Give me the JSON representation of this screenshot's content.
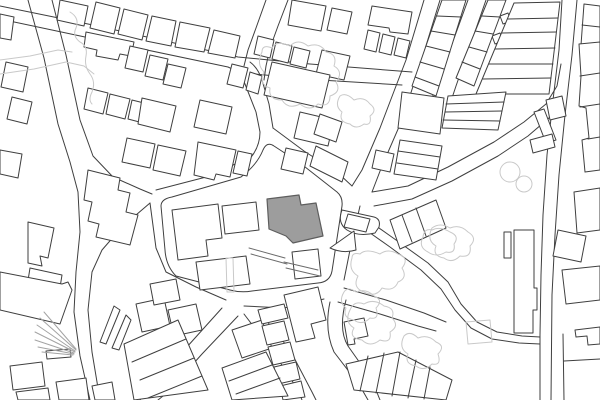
{
  "map": {
    "kind": "architectural-site-plan-figure-ground",
    "background": "#ffffff",
    "colors": {
      "outline": "#3f3f3f",
      "light": "#c9c9c9",
      "rail": "#a3a3a3",
      "site_fill": "#9d9d9d",
      "site_stroke": "#5e5e5e",
      "steps": "#6b6b6b",
      "white": "#ffffff"
    },
    "layers": [
      {
        "name": "road-edges",
        "stroke": "outline",
        "fill": "none",
        "width": 1,
        "paths": [
          "M0,6 L88,24 L238,57 L310,64 L412,72",
          "M0,19 L85,37 L228,67",
          "M254,74 L320,80 L402,85",
          "M266,0 L256,28 L248,50 L244,66",
          "M288,0 L278,26 L270,48 L266,66 L264,80",
          "M228,67 Q240,72 245,84 L256,112 L260,132 Q260,145 252,156 L210,176 L156,190",
          "M250,62 Q258,68 262,80 L269,104 L273,128",
          "M273,128 L304,151 L338,173 L352,186",
          "M28,0 L44,58 L58,124 L70,162 L78,192 L80,232 L76,272 L74,312 L80,356 L90,400",
          "M52,0 L66,55 L80,120 L93,156 L113,177 L140,189 L152,194",
          "M150,203 L122,227 L102,250 L92,272 L88,310 L92,352 L100,400",
          "M150,203 L156,248 L166,272 L196,287 L226,300",
          "M222,308 L186,348 L152,386 L140,400",
          "M238,316 L202,354 L168,392 L158,400",
          "M244,314 L276,356 L298,390 L302,400",
          "M258,310 L290,350 L312,392 L316,400",
          "M244,306 L284,308 L324,299",
          "M360,206 L350,250 L344,280",
          "M330,302 Q324,330 334,352 L360,386 L368,400",
          "M346,300 Q338,330 348,346 L372,380 L380,400",
          "M344,288 L386,300 L424,313 L446,322",
          "M338,302 L380,314 L418,326 L436,331",
          "M424,0 L406,60 L396,86 L380,128 L362,170 L352,186",
          "M440,0 L421,62 L402,120 L382,166 L372,192",
          "M372,192 L408,186 L448,167 L494,142 L524,122 L546,104 L557,86 L561,64",
          "M374,206 L412,199 L452,181 L498,156 L528,136 L549,118 L556,102",
          "M468,0 L452,44 L438,82 L432,98",
          "M486,0 L470,46 L456,86 L448,110 L444,126",
          "M562,0 L559,50 L553,100 L547,155 L543,215 L541,275 L540,335 L540,400",
          "M577,0 L572,55 L565,115 L559,175 L555,235 L552,295 L551,400",
          "M362,216 L396,240 L428,263 L448,282 L461,304 L477,322 L497,332 L522,336 L540,337",
          "M356,223 L390,247 L421,270 L441,289 L455,310 L471,328 L492,339 L519,343 L540,344",
          "M563,334 L564,400",
          "M564,361 L600,359"
        ]
      },
      {
        "name": "blocks",
        "stroke": "outline",
        "fill": "white",
        "width": 1,
        "paths": [
          "M161,206 L165,250 Q166,266 176,276 L230,290 Q241,293 252,291 L318,283 Q330,282 332,271 L342,206 Q343,197 337,192 L300,163 L274,146 Q267,141 263,150 Q257,165 241,177 L172,197 Q161,199 161,206 Z",
          "M342,210 L374,217 Q381,219 379,227 L375,233 Q358,237 347,230 Q337,223 342,210 Z"
        ]
      },
      {
        "name": "buildings",
        "stroke": "outline",
        "fill": "white",
        "width": 1,
        "paths": [
          "M96,2 L120,8 L114,34 L90,28 Z",
          "M124,9 L148,15 L142,40 L118,34 Z",
          "M152,16 L176,21 L171,46 L146,41 Z",
          "M180,22 L210,28 L204,52 L175,47 Z",
          "M214,30 L240,36 L235,58 L208,53 Z",
          "M60,0 L88,6 L84,26 L57,20 Z",
          "M292,0 L326,6 L321,31 L288,25 Z",
          "M332,8 L352,12 L347,34 L327,30 Z",
          "M372,6 L412,12 L408,34 L390,32 L389,28 L368,25 Z",
          "M368,30 L380,33 L376,52 L364,49 Z",
          "M383,34 L395,37 L391,55 L379,52 Z",
          "M398,38 L410,41 L406,58 L394,55 Z",
          "M0,14 L14,17 L11,40 L0,38 Z",
          "M6,62 L28,67 L23,92 L1,87 Z",
          "M12,97 L32,102 L27,124 L7,119 Z",
          "M0,150 L22,154 L18,178 L0,174 Z",
          "M28,222 L54,228 L48,258 L40,256 L42,266 L28,263 Z",
          "M30,268 L62,275 L58,300 L26,293 Z",
          "M86,32 L134,42 L131,56 L120,54 L118,60 L96,56 L97,50 L84,47 Z",
          "M130,46 L148,50 L143,72 L125,68 Z",
          "M150,55 L168,59 L163,80 L145,76 Z",
          "M168,64 L186,68 L181,88 L163,84 Z",
          "M88,88 L108,93 L103,114 L84,109 Z",
          "M110,94 L130,99 L125,119 L106,114 Z",
          "M132,100 L152,105 L147,124 L128,119 Z",
          "M142,98 L176,106 L170,132 L138,124 Z",
          "M127,138 L155,144 L150,168 L122,162 Z",
          "M158,145 L186,151 L180,176 L153,170 Z",
          "M198,142 L236,150 L230,177 L216,174 L214,180 L194,175 Z",
          "M238,151 L252,154 L247,176 L233,173 Z",
          "M200,100 L232,107 L226,134 L194,127 Z",
          "M232,64 L248,68 L243,88 L227,84 Z",
          "M250,72 L262,76 L258,94 L246,90 Z",
          "M258,36 L274,40 L270,58 L254,54 Z",
          "M276,42 L292,46 L288,63 L272,59 Z",
          "M294,47 L310,51 L306,68 L290,64 Z",
          "M322,50 L350,56 L344,80 L316,74 Z",
          "M272,62 L330,75 L322,108 L264,95 Z",
          "M300,112 L334,120 L328,146 L294,138 Z",
          "M286,148 L308,153 L303,174 L281,169 Z",
          "M316,146 L348,162 L342,182 L310,166 Z",
          "M320,114 L342,122 L336,142 L314,134 Z",
          "M402,92 L444,98 L440,134 L398,128 Z",
          "M376,150 L394,154 L390,172 L372,168 Z",
          "M492,36 L500,33 L503,41 L495,44 Z",
          "M500,16 L508,13 L511,21 L503,24 Z",
          "M584,4 L600,6 L600,48 L581,45 Z",
          "M546,100 L562,96 L566,116 L550,120 Z",
          "M534,112 L544,109 L556,140 L546,143 Z",
          "M530,140 L552,134 L555,147 L533,153 Z",
          "M574,192 L600,188 L600,230 L577,233 Z",
          "M558,230 L586,236 L581,262 L553,256 Z",
          "M562,270 L600,266 L600,300 L566,304 Z",
          "M575,330 L600,327 L600,344 L588,345 L587,336 L576,337 Z",
          "M514,230 L534,230 L534,288 L537,288 L537,310 L533,310 L533,333 L514,333 Z",
          "M504,232 L511,232 L511,258 L504,258 Z",
          "M348,214 L370,219 L366,232 L344,227 Z",
          "M330,248 L354,231 L356,250 Q343,254 330,248 Z",
          "M172,210 L218,204 L222,238 L206,240 L208,256 L178,260 Z",
          "M222,206 L256,202 L259,230 L225,234 Z",
          "M196,262 L246,256 L250,284 L200,290 Z",
          "M292,252 L318,249 L321,276 L295,279 Z",
          "M88,170 L120,178 L118,190 L130,193 L126,212 L138,215 L130,245 L96,237 L99,224 L88,221 L92,202 L84,200 Z",
          "M0,272 L62,284 L68,282 L72,290 L60,324 L0,310 Z",
          "M46,351 L70,349 L71,357 L47,359 Z",
          "M100,342 L114,306 L120,310 L106,344 Z",
          "M112,348 L126,315 L131,320 L119,350 Z",
          "M10,366 L42,362 L45,386 L13,390 Z",
          "M16,392 L48,388 L50,400 L18,400 Z",
          "M56,382 L86,378 L89,400 L59,400 Z",
          "M92,386 L112,382 L115,400 L95,400 Z",
          "M136,304 L164,298 L170,326 L142,332 Z",
          "M168,310 L196,304 L202,330 L174,336 Z",
          "M150,284 L176,279 L180,300 L154,305 Z",
          "M232,330 L262,320 L272,348 L242,358 Z",
          "M258,310 L284,304 L288,318 L262,324 Z",
          "M262,326 L284,321 L289,340 L267,345 Z",
          "M268,347 L290,342 L295,360 L273,365 Z",
          "M274,367 L296,362 L300,379 L278,384 Z",
          "M280,386 L301,381 L305,397 L283,400 Z",
          "M284,295 L318,287 L326,320 L311,324 L315,338 L296,342 Z",
          "M344,322 L364,318 L368,336 L354,339 L355,344 L348,345 Z"
        ]
      },
      {
        "name": "terrace-rows",
        "stroke": "outline",
        "fill": "white",
        "width": 1,
        "rows": [
          {
            "outline": "M442,0 L466,0 L436,96 L412,86 Z",
            "lines": [
              "M437,16 L461,17",
              "M431,31 L455,35",
              "M426,46 L450,52",
              "M420,62 L444,69",
              "M415,77 L439,86"
            ]
          },
          {
            "outline": "M488,0 L506,0 L474,86 L456,78 Z",
            "lines": [
              "M482,16 L500,17",
              "M475,31 L493,34",
              "M469,47 L487,52",
              "M462,62 L480,69"
            ]
          },
          {
            "outline": "M514,3 L560,2 L549,94 L476,94 Z",
            "lines": [
              "M508,19 L558,18",
              "M502,33 L556,32",
              "M495,49 L555,48",
              "M489,64 L553,64",
              "M483,79 L551,78"
            ]
          },
          {
            "outline": "M448,96 L506,92 L498,130 L442,128 Z",
            "lines": [
              "M446,104 L504,102",
              "M445,112 L502,111",
              "M443,120 L500,121"
            ]
          },
          {
            "outline": "M400,140 L442,146 L436,180 L394,174 Z",
            "lines": [
              "M398,151 L440,157",
              "M397,163 L438,169"
            ]
          },
          {
            "outline": "M390,220 L436,200 L446,228 L400,249 Z",
            "lines": [
              "M402,215 L412,242",
              "M416,208 L426,236"
            ]
          },
          {
            "outline": "M579,44 L600,42 L600,170 L585,172 L582,140 L589,138 L586,108 L579,106 L581,76 Z",
            "lines": [
              "M580,76 L600,73",
              "M580,107 L600,104",
              "M588,139 L600,137",
              "M582,25 L600,27"
            ]
          },
          {
            "outline": "M124,344 L178,320 L208,390 L134,400 Z",
            "lines": [
              "M132,362 L186,339",
              "M140,380 L194,358",
              "M148,398 L202,376"
            ]
          },
          {
            "outline": "M222,368 L266,352 L288,396 L232,400 Z",
            "lines": [
              "M229,381 L272,365",
              "M236,394 L280,378"
            ]
          },
          {
            "outline": "M346,364 L398,352 L452,380 L446,400 L354,390 Z",
            "lines": [
              "M368,356 L360,391",
              "M384,353 L376,393",
              "M400,352 L392,396",
              "M416,360 L408,398",
              "M430,367 L424,399"
            ]
          }
        ]
      },
      {
        "name": "rail-fan",
        "stroke": "rail",
        "fill": "none",
        "width": 1,
        "paths": [
          "M76,349 L44,312",
          "M76,350 L40,318",
          "M75,351 L37,325",
          "M75,352 L35,332",
          "M74,353 L35,340",
          "M74,354 L38,347",
          "M73,355 L42,352"
        ]
      },
      {
        "name": "light-features",
        "stroke": "light",
        "fill": "none",
        "width": 1,
        "paths": [
          "M0,60 L30,56 L58,50 L72,52",
          "M0,74 L34,69 L66,62 L84,66 L94,74",
          "M70,12 Q80,18 76,28 Q72,36 80,42 Q88,46 86,56 Q84,66 90,74 Q96,82 92,92 Q88,100 92,104",
          "M262,52 Q256,64 264,72 Q258,84 270,88 Q268,100 282,100 Q288,110 300,104 Q310,112 318,104 Q330,108 330,96 Q342,92 336,82 Q344,72 334,66 Q338,54 326,52 Q320,42 308,46 Q298,38 290,46 Q276,40 272,48 Q262,44 262,52 Z",
          "M340,96 Q334,106 342,112 Q338,122 350,124 Q356,130 364,124 Q372,126 370,116 Q378,110 370,104 Q364,96 354,100 Q346,92 340,96 Z",
          "M352,258 Q348,270 358,276 Q352,288 364,292 Q376,298 382,288 Q394,292 398,282 Q408,278 402,268 Q410,258 398,254 Q388,248 380,254 Q366,248 360,254 Q352,252 352,258 Z",
          "M432,228 Q426,240 436,246 Q432,256 444,258 Q452,264 460,256 Q472,258 470,246 Q478,238 468,232 Q460,224 450,228 Q440,222 432,228 Z",
          "M500,172 a10,10 0 1 0 20,0 a10,10 0 1 0 -20,0",
          "M516,184 a8,8 0 1 0 16,0 a8,8 0 1 0 -16,0",
          "M466,322 L490,320 L492,342 L468,344 Z",
          "M404,336 Q398,348 408,354 Q404,364 416,366 Q424,372 432,364 Q442,366 438,354 Q446,346 436,342 Q428,334 418,338 Q410,330 404,336 Z",
          "M344,292 Q338,302 346,308 Q342,318 354,320 Q362,326 370,318 Q380,320 376,308 Q384,300 374,296 Q366,288 356,292 Q348,286 344,292 Z",
          "M350,310 Q344,322 354,328 Q348,338 362,340 Q370,348 380,340 Q392,344 390,332 Q400,326 392,318 Q396,308 384,306 Q374,298 364,304 Q354,300 350,310 Z",
          "M226,258 L233,258 L234,292 L227,292 Z",
          "M423,237 Q418,247 428,252 Q436,258 446,252 Q456,254 454,244 Q460,236 450,232 Q440,226 432,230 Q424,228 423,237 Z"
        ]
      },
      {
        "name": "site-building",
        "stroke": "site_stroke",
        "fill": "site_fill",
        "width": 1.2,
        "paths": [
          "M267,199 L299,195 L301,205 L316,203 L323,236 L293,243 L286,236 L269,229 Z"
        ]
      },
      {
        "name": "site-steps",
        "stroke": "steps",
        "fill": "none",
        "width": 1,
        "paths": [
          "M249,248 L285,258",
          "M251,254 L287,264",
          "M284,262 L318,270",
          "M286,268 L320,276"
        ]
      }
    ]
  }
}
